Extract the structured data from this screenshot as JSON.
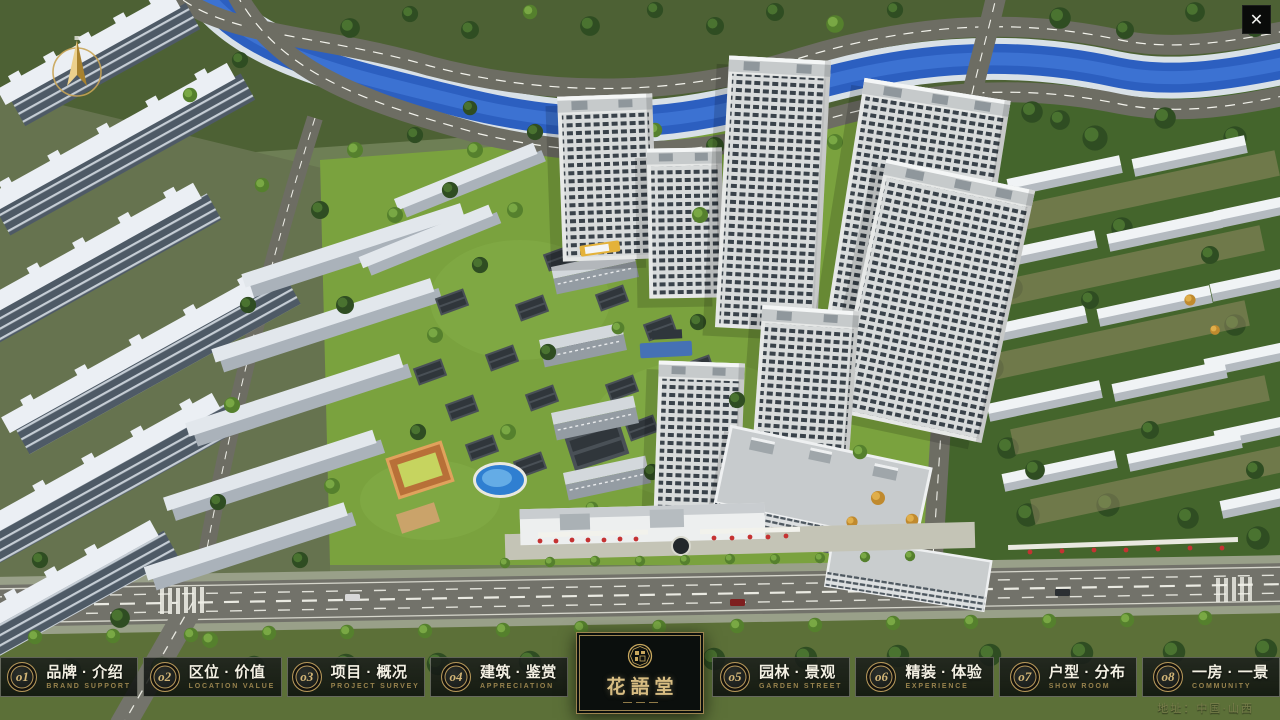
{
  "window": {
    "close_glyph": "✕"
  },
  "compass": {
    "icon": "north-arrow-compass"
  },
  "menu": {
    "items": [
      {
        "number": "o1",
        "label": "品牌 · 介绍",
        "sublabel": "BRAND SUPPORT"
      },
      {
        "number": "o2",
        "label": "区位 · 价值",
        "sublabel": "LOCATION VALUE"
      },
      {
        "number": "o3",
        "label": "项目 · 概况",
        "sublabel": "PROJECT SURVEY"
      },
      {
        "number": "o4",
        "label": "建筑 · 鉴赏",
        "sublabel": "APPRECIATION"
      },
      {
        "number": "o5",
        "label": "园林 · 景观",
        "sublabel": "GARDEN STREET"
      },
      {
        "number": "o6",
        "label": "精装 · 体验",
        "sublabel": "EXPERIENCE"
      },
      {
        "number": "o7",
        "label": "户型 · 分布",
        "sublabel": "SHOW ROOM"
      },
      {
        "number": "o8",
        "label": "一房 · 一景",
        "sublabel": "COMMUNITY"
      }
    ]
  },
  "logo": {
    "title": "花語堂",
    "seal": "round-seal-emblem"
  },
  "footer": {
    "address": "地址：中国·山西"
  },
  "colors": {
    "gold": "#b7985a",
    "panel": "rgba(12,16,14,0.86)",
    "river": "#2c5fc0",
    "grass": "#7aa23e"
  }
}
